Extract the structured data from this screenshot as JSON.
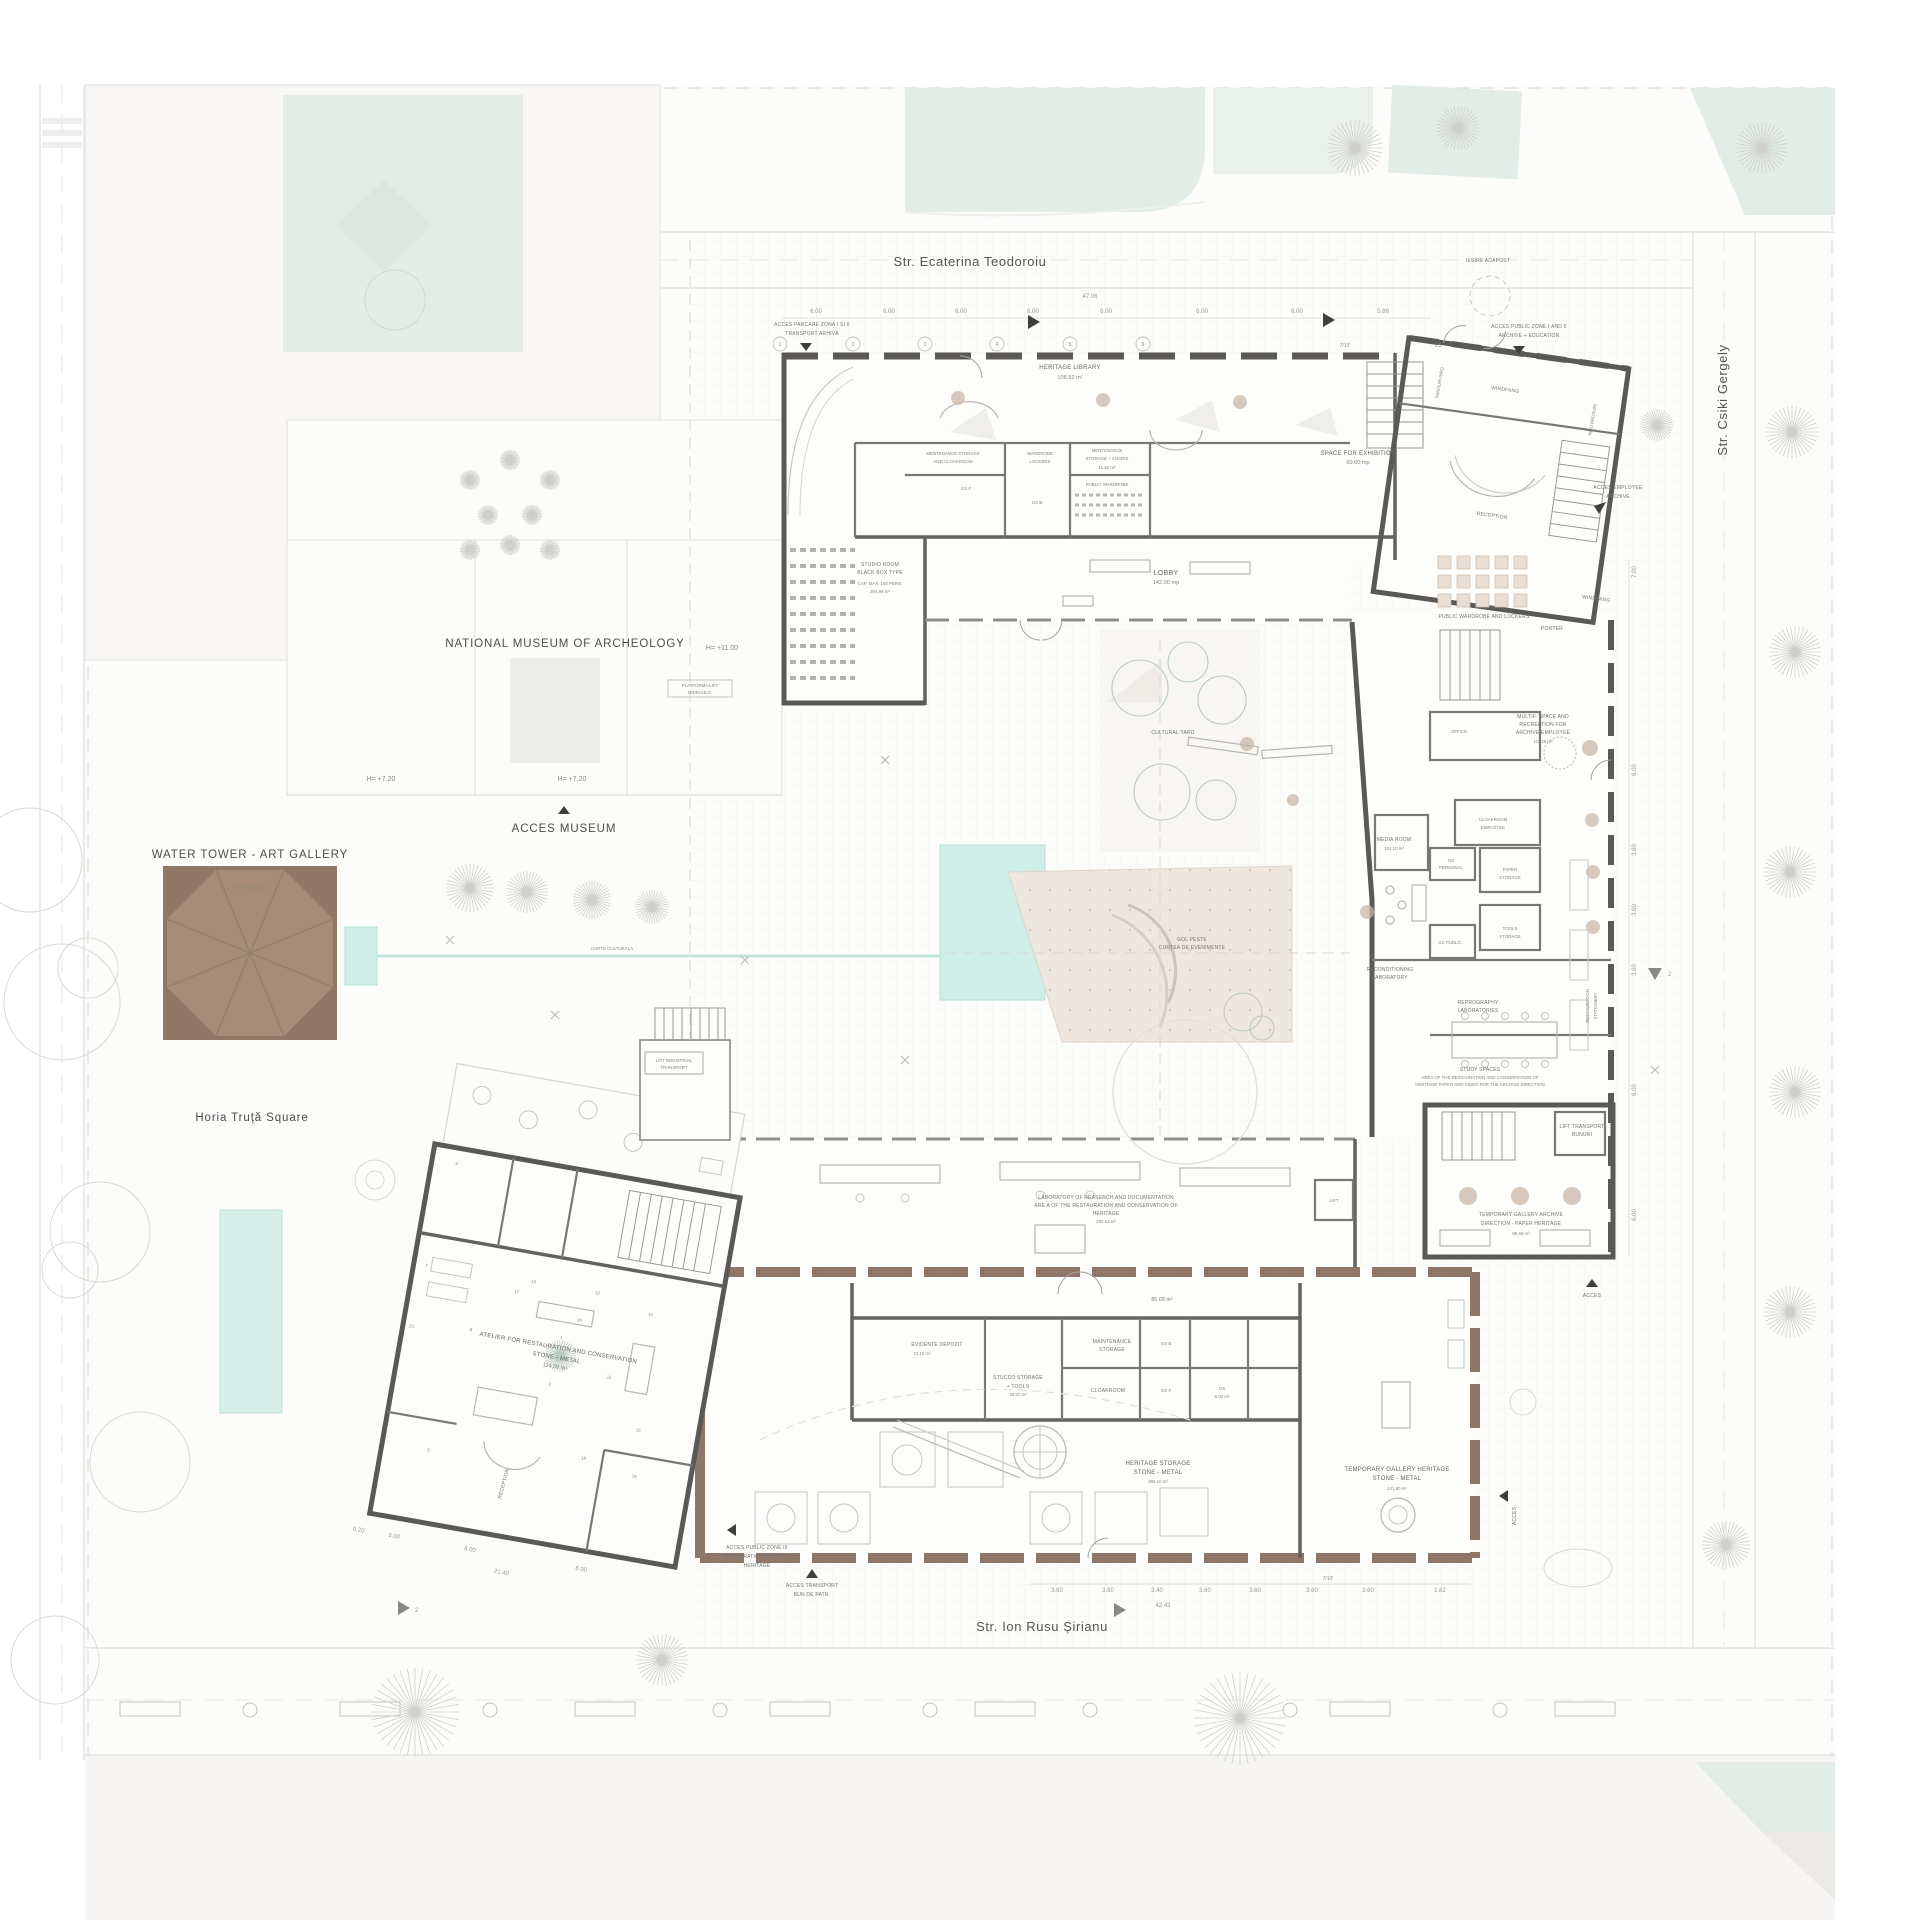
{
  "colors": {
    "wall_grey": "#5b5955",
    "wall_brown": "#8e7668",
    "tower_fill": "#a58d7a",
    "tower_dark": "#8f7867",
    "pool": "#cfeee7",
    "park_green": "#e3ece6",
    "courtyard_beige": "#eee7df"
  },
  "streets": {
    "top": "Str. Ecaterina Teodoroiu",
    "right": "Str. Csiki Gergely",
    "bottom": "Str. Ion Rusu Șirianu"
  },
  "site": {
    "museum": "NATIONAL MUSEUM OF ARCHEOLOGY",
    "square": "Horia Truță Square",
    "water_tower": "WATER TOWER - ART GALLERY",
    "tower_height": "H= +38.00",
    "h_720": "H= +7.20",
    "h_720b": "H= +7.20",
    "h_1100": "H= +11.00",
    "acces_museum": "ACCES MUSEUM",
    "iesire_adapost": "IESIRE ADAPOST",
    "curte_culturala": "CURTE CULTURALA",
    "platforma_l1": "PLATFORMA LIFT",
    "platforma_l2": "HIDRAULIC"
  },
  "access": {
    "parcare_l1": "ACCES PARCARE ZONA I SI II",
    "parcare_l2": "TRANSPORT ARHIVĂ",
    "public12_l1": "ACCES PUBLIC ZONE I AND II",
    "public12_l2": "ARCHIVE + EDUCATION",
    "employee_l1": "ACCES EMPLOYEE",
    "employee_l2": "ARCHIVE",
    "public3_l1": "ACCES PUBLIC ZONE III",
    "public3_l2": "RESTAURATION/CONSERV.",
    "public3_l3": "HERITAGE",
    "transport_l1": "ACCES TRANSPORT",
    "transport_l2": "BUN DE PATR.",
    "acces_se": "ACCES",
    "acces_e": "ACCES"
  },
  "rooms": {
    "heritage_library": {
      "l1": "HERITAGE LIBRARY",
      "area": "108.92 m²"
    },
    "mentenance_cloakroom": {
      "l1": "MENTENANCE STORAGE",
      "l2": "AND CLOAKROOM"
    },
    "wardrobe_lockers": {
      "l1": "WARDROBE",
      "l2": "LOCKERS"
    },
    "mentenance_chairs": {
      "l1": "MENTENANCE",
      "l2": "STORAGE + CHAIRS",
      "area": "11.40 m²"
    },
    "public_wardrobe": {
      "l1": "PUBLIC WARDROBE"
    },
    "gs_f": {
      "l1": "GS F"
    },
    "gs_b": {
      "l1": "GS B"
    },
    "studio_room": {
      "l1": "STUDIO ROOM",
      "l2": "BLACK BOX TYPE",
      "l3": "CAP. MAX. 160 PERS.",
      "area": "204.98 m²"
    },
    "lobby": {
      "l1": "LOBBY",
      "area": "142.00 mp"
    },
    "space_exhibition": {
      "l1": "SPACE FOR EXHIBITION",
      "area": "60.00 mp"
    },
    "windfang_n": {
      "l1": "WINDFANG"
    },
    "panouri_info": {
      "l1": "PANOURI INFO"
    },
    "info_brosuri": {
      "l1": "INFO BROSURI"
    },
    "reception_n": {
      "l1": "RECEPTION"
    },
    "public_wardrobe_lockers": {
      "l1": "PUBLIC WARDROBE AND LOCKERS"
    },
    "porter": {
      "l1": "PORTER"
    },
    "windfang_e": {
      "l1": "WINDFANG"
    },
    "multif_space": {
      "l1": "MULTIF. SPACE AND",
      "l2": "RECREATION FOR",
      "l3": "ARCHIVE EMPLOYEE",
      "area": "111.29 m²"
    },
    "office": {
      "l1": "OFFICE"
    },
    "cloakroom_employee": {
      "l1": "CLOAKROOM",
      "l2": "EMPLOYEE"
    },
    "gs_personal": {
      "l1": "GS",
      "l2": "PERSONAL"
    },
    "paper_storage": {
      "l1": "PAPER",
      "l2": "STORAGE"
    },
    "tools_storage": {
      "l1": "TOOLS",
      "l2": "STORAGE"
    },
    "gs_public": {
      "l1": "GS PUBLIC"
    },
    "media_room": {
      "l1": "MEDIA ROOM",
      "area": "101.10 m²"
    },
    "cultural_yard": {
      "l1": "CULTURAL YARD"
    },
    "gol_peste": {
      "l1": "GOL PESTE",
      "l2": "CURTEA DE EVENIMENTE"
    },
    "reconditioning_lab": {
      "l1": "RECONDITIONING",
      "l2": "LABORATORY"
    },
    "reprography": {
      "l1": "REPROGRAPHY",
      "l2": "LABORATORIES"
    },
    "restauration_stationery": {
      "l1": "RESTAURATION",
      "l2": "STATIONERY"
    },
    "study_spaces": {
      "l1": "STUDY SPACES",
      "l2": "AREA OF THE RESTAURATION AND CONSERVATION OF",
      "l3": "HERITAGE PAPER AND VIDEO FOR THE ARCHIVE DIRECTION"
    },
    "lift_transport": {
      "l1": "LIFT TRANSPORT",
      "l2": "BUNURI"
    },
    "temp_gallery_archive": {
      "l1": "TEMPORARY GALLERY ARCHIVE",
      "l2": "DIRECTION - PAPER HERITAGE",
      "area": "66.40 m²"
    },
    "laboratory_research": {
      "l1": "LABORATORY OF REASERCH AND DOCUMENTATION",
      "l2": "ARE A OF THE RESTAURATION AND CONSERVATION OF",
      "l3": "HERITAGE",
      "area": "292.14 m²"
    },
    "lift": {
      "l1": "LIFT"
    },
    "corridor_area": {
      "area": "86.09 m²"
    },
    "lift_industrial": {
      "l1": "LIFT INDUSTRIAL",
      "l2": "TRANSPORT"
    },
    "evidente_depozit": {
      "l1": "EVIDENTE DEPOZIT",
      "area": "72.10 m²"
    },
    "stucco_storage": {
      "l1": "STUCCO STORAGE",
      "l2": "+ TOOLS",
      "area": "25.57 m²"
    },
    "maintenance_storage": {
      "l1": "MAINTENANCE",
      "l2": "STORAGE"
    },
    "cloakroom": {
      "l1": "CLOAKROOM"
    },
    "gs_b2": {
      "l1": "GS B"
    },
    "gs_f2": {
      "l1": "GS F"
    },
    "gs_small": {
      "l1": "GS",
      "area": "5.00 m²"
    },
    "heritage_storage": {
      "l1": "HERITAGE STORAGE",
      "l2": "STONE - METAL",
      "area": "296.10 m²"
    },
    "temp_gallery_heritage": {
      "l1": "TEMPORARY GALLERY HERITAGE",
      "l2": "STONE - METAL",
      "area": "141.80 m²"
    },
    "atelier": {
      "l1": "ATELIER FOR RESTAURATION AND CONSERVATION",
      "l2": "STONE - METAL",
      "area": "114.56 m²"
    },
    "reception_s": {
      "l1": "RECEPTION"
    }
  },
  "dims": {
    "total_top": "47.06",
    "top": [
      "6.00",
      "6.00",
      "6.00",
      "6.00",
      "6.00",
      "6.00",
      "6.00",
      "5.86"
    ],
    "bottom": [
      "3.60",
      "3.60",
      "3.40",
      "3.60",
      "3.60",
      "3.60",
      "3.60",
      "1.82"
    ],
    "bottom_total": "42.43",
    "bottom_left": [
      "0.20",
      "3.00",
      "6.00",
      "6.00",
      "21.40"
    ],
    "right": [
      "7.00",
      "6.00",
      "3.60",
      "3.60",
      "3.60",
      "6.00",
      "6.00"
    ],
    "grid_row": [
      "1",
      "2",
      "3",
      "4",
      "5",
      "6",
      "7/10'",
      "1.3"
    ]
  },
  "markers": {
    "section_2": "2"
  },
  "atelier_numbers": [
    "1",
    "2",
    "4",
    "5",
    "7",
    "8",
    "10",
    "11",
    "12",
    "13",
    "14",
    "15",
    "17",
    "18",
    "20",
    "21"
  ]
}
